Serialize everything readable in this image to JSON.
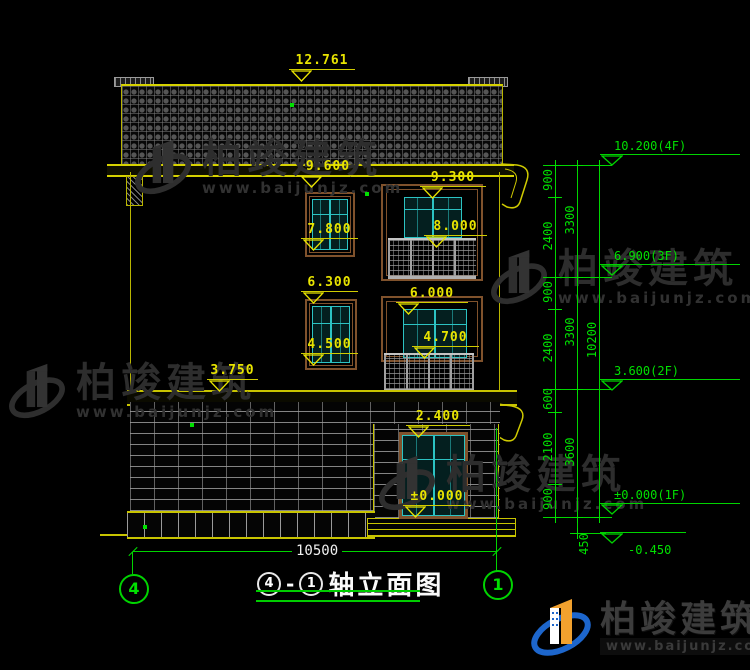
{
  "watermark": {
    "brand": "柏竣建筑",
    "site": "www.baijunjz.com"
  },
  "footer": {
    "brand": "柏竣建筑",
    "site": "www.baijunjz.com"
  },
  "title": {
    "axis_from": "4",
    "separator": "-",
    "axis_to": "1",
    "text": "轴立面图"
  },
  "axes": {
    "left": "4",
    "right": "1"
  },
  "dims": {
    "overall_width": "10500",
    "ridge": "12.761",
    "eave_left": "9.600",
    "parapet_right": "9.300",
    "win3f_left": "7.800",
    "win3f_right": "8.000",
    "win2f_left_head": "6.300",
    "win2f_right_head": "6.000",
    "win2f_left_sill": "4.500",
    "win2f_right_sill": "4.700",
    "belt_left": "3.750",
    "canopy": "2.400",
    "entrance_level": "±0.000"
  },
  "chain": {
    "col1": [
      "900",
      "2400",
      "900",
      "2400",
      "600",
      "2100",
      "900"
    ],
    "col2": [
      "3300",
      "3300",
      "3600"
    ],
    "col3": [
      "10200"
    ],
    "foundation": "450"
  },
  "levels": [
    "10.200(4F)",
    "6.900(3F)",
    "3.600(2F)",
    "±0.000(1F)",
    "-0.450"
  ]
}
